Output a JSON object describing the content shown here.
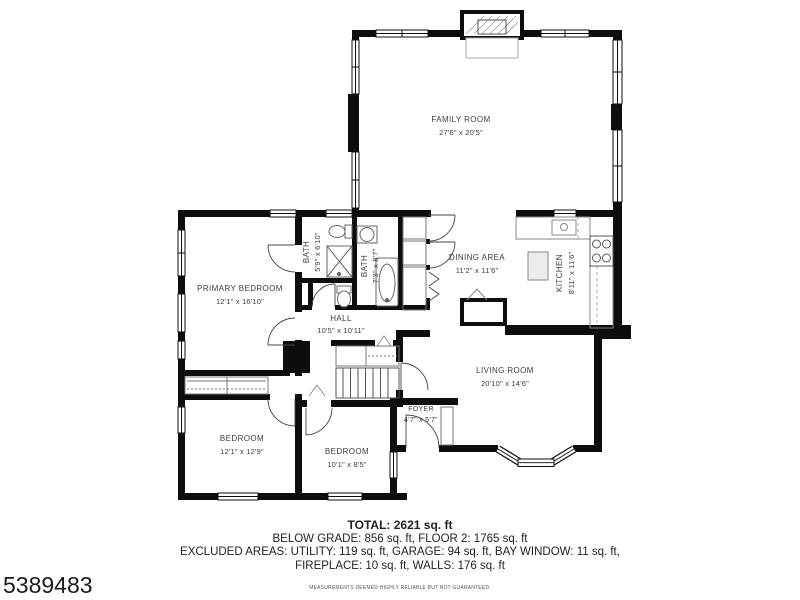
{
  "rooms": {
    "family_room": {
      "name": "FAMILY ROOM",
      "dims": "27'6\" x 20'5\""
    },
    "primary_bedroom": {
      "name": "PRIMARY BEDROOM",
      "dims": "12'1\" x 16'10\""
    },
    "bath_small": {
      "name": "BATH",
      "dims": "5'9\" x 6'10\""
    },
    "bath_large": {
      "name": "BATH",
      "dims": "7'3\" x 8'7\""
    },
    "dining_area": {
      "name": "DINING AREA",
      "dims": "11'2\" x 11'6\""
    },
    "kitchen": {
      "name": "KITCHEN",
      "dims": "8'11\" x 11'6\""
    },
    "hall": {
      "name": "HALL",
      "dims": "10'5\" x 10'11\""
    },
    "living_room": {
      "name": "LIVING ROOM",
      "dims": "20'10\" x 14'6\""
    },
    "foyer": {
      "name": "FOYER",
      "dims": "4'7\" x 5'7\""
    },
    "bedroom_1": {
      "name": "BEDROOM",
      "dims": "12'1\" x 12'9\""
    },
    "bedroom_2": {
      "name": "BEDROOM",
      "dims": "10'1\" x 8'5\""
    }
  },
  "summary": {
    "total": "TOTAL: 2621 sq. ft",
    "line2": "BELOW GRADE: 856 sq. ft, FLOOR 2: 1765 sq. ft",
    "line3": "EXCLUDED AREAS: UTILITY: 119 sq. ft, GARAGE: 94 sq. ft, BAY WINDOW: 11 sq. ft,",
    "line4": "FIREPLACE: 10 sq. ft, WALLS: 176 sq. ft",
    "disclaimer": "MEASUREMENTS DEEMED HIGHLY RELIABLE BUT NOT GUARANTEED."
  },
  "listing_id": "5389483",
  "colors": {
    "wall": "#0d0d0d",
    "text": "#3d3d3d",
    "fixture": "#777777",
    "background": "#ffffff"
  }
}
